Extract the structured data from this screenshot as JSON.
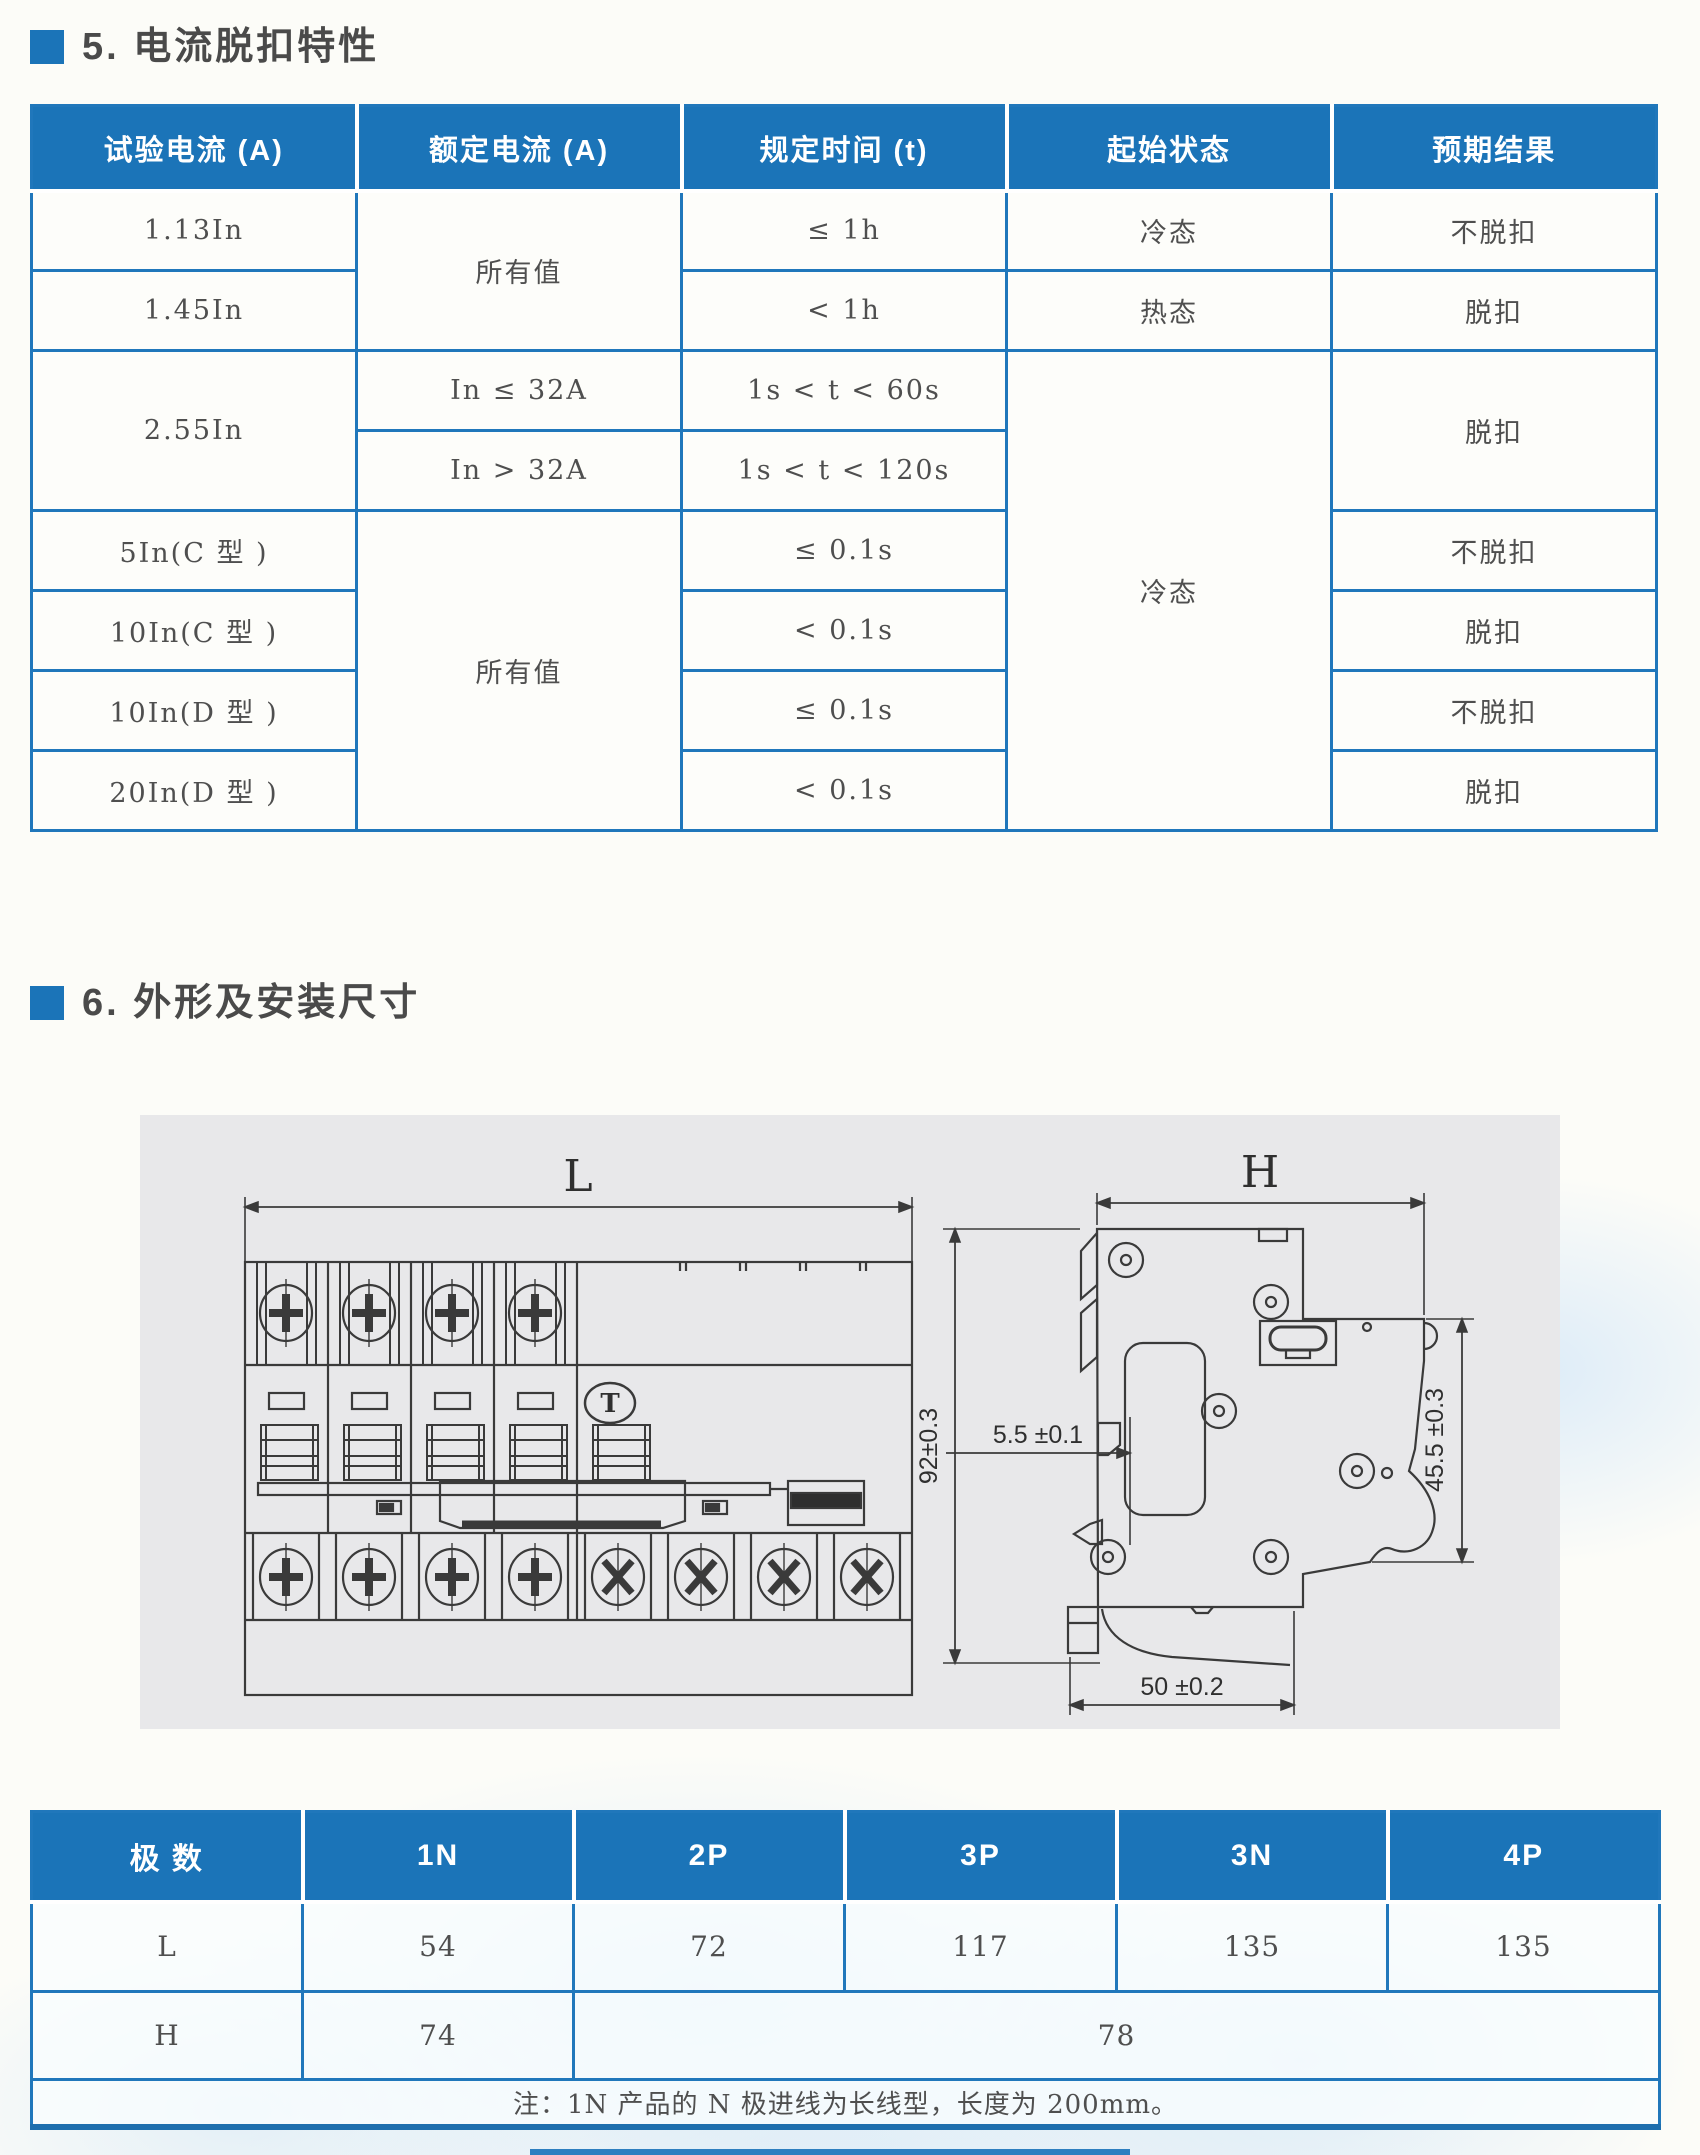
{
  "sections": {
    "s5": {
      "title": "5. 电流脱扣特性"
    },
    "s6": {
      "title": "6. 外形及安装尺寸"
    }
  },
  "trip_table": {
    "headers": {
      "c1": "试验电流 (A)",
      "c2": "额定电流 (A)",
      "c3": "规定时间 (t)",
      "c4": "起始状态",
      "c5": "预期结果"
    },
    "rows": {
      "r1": {
        "test_current": "1.13In",
        "rated_current": "所有值",
        "time": "≤ 1h",
        "initial_state": "冷态",
        "result": "不脱扣"
      },
      "r2": {
        "test_current": "1.45In",
        "time": "< 1h",
        "initial_state": "热态",
        "result": "脱扣"
      },
      "r3": {
        "test_current": "2.55In",
        "rated_current": "In ≤ 32A",
        "time": "1s < t < 60s",
        "initial_state": "冷态",
        "result": "脱扣"
      },
      "r4": {
        "rated_current": "In > 32A",
        "time": "1s < t < 120s"
      },
      "r5": {
        "test_current": "5In(C 型 )",
        "rated_current": "所有值",
        "time": "≤ 0.1s",
        "result": "不脱扣"
      },
      "r6": {
        "test_current": "10In(C 型 )",
        "time": "< 0.1s",
        "result": "脱扣"
      },
      "r7": {
        "test_current": "10In(D 型 )",
        "time": "≤ 0.1s",
        "result": "不脱扣"
      },
      "r8": {
        "test_current": "20In(D 型 )",
        "time": "< 0.1s",
        "result": "脱扣"
      }
    }
  },
  "drawing": {
    "front_view": {
      "width_dim_label": "L",
      "test_button_label": "T"
    },
    "side_view": {
      "height_dim_label": "H",
      "overall_height": "92±0.3",
      "rail_offset": "5.5 ±0.1",
      "front_depth": "45.5 ±0.3",
      "rail_width": "50 ±0.2"
    }
  },
  "dim_table": {
    "headers": {
      "poles": "极 数",
      "p1n": "1N",
      "p2p": "2P",
      "p3p": "3P",
      "p3n": "3N",
      "p4p": "4P"
    },
    "row_l": {
      "label": "L",
      "p1n": "54",
      "p2p": "72",
      "p3p": "117",
      "p3n": "135",
      "p4p": "135"
    },
    "row_h": {
      "label": "H",
      "p1n": "74",
      "others": "78"
    },
    "note": "注：1N 产品的 N 极进线为长线型，长度为 200mm。"
  },
  "colors": {
    "header_blue": "#1b74b8",
    "grid_blue": "#2077bb",
    "title_gray": "#4a4a4a",
    "line_gray": "#3a3a3a",
    "panel_gray": "#e8e8ea"
  }
}
